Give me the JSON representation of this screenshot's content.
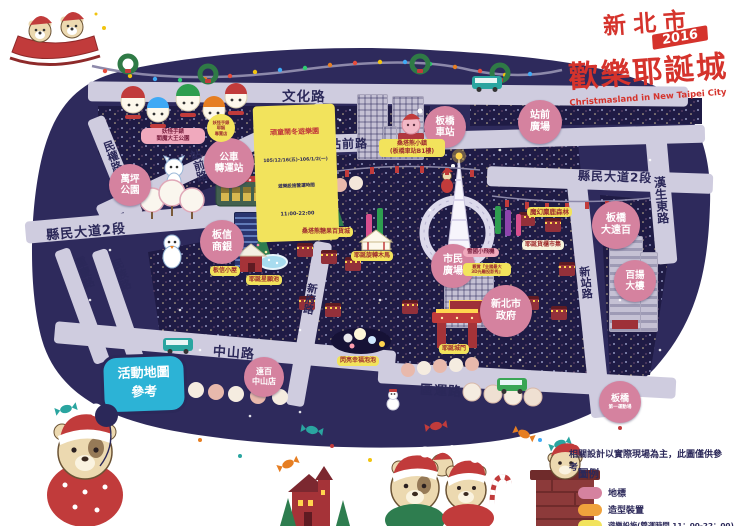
{
  "title": {
    "city": "新北市",
    "main": "歡樂耶誕城",
    "year": "2016",
    "subtitle": "Christmasland in New Taipei City"
  },
  "info_box": {
    "text": "活動地圖\n參考"
  },
  "roads": {
    "wenhua": "文化路",
    "zhanqian": "站前路",
    "xianmin": "縣民大道2段",
    "hansheng": "漢生東路",
    "minquan": "民權路",
    "chongqing": "重慶路",
    "minzu": "民族路",
    "xinfu": "新府路",
    "xinzhan": "新站路",
    "zhongshan": "中山路",
    "quyun": "區運路"
  },
  "landmarks": {
    "banqiao_station": "板橋\n車站",
    "zhanqian_square": "站前\n廣場",
    "bus_terminal": "公車\n轉運站",
    "wanping_park": "萬坪\n公園",
    "banxin_bank": "板信\n商銀",
    "mega_far_eastern": "板橋\n大遠百",
    "baiyang_tower": "百揚\n大樓",
    "civic_square": "市民\n廣場",
    "city_hall": "新北市\n政府",
    "fe_zhongshan": "遠百\n中山店",
    "stadium_line1": "板橋",
    "stadium_line2": "第一運動場"
  },
  "attractions": {
    "playground_title": "頑童鬧冬遊樂園",
    "playground_dates": "105/12/16(五)-106/1/2(一)",
    "playground_line2": "遊樂設施營運時間",
    "playground_hours": "11:00-22:00",
    "santa_bear_town": "桑塔熊小鎮\n(板橋車站B1樓)",
    "yokai_park": "妖怪手錶\n閻魔大王公園",
    "yokai_shop": "妖怪手錶\n耶誕\n專賣店",
    "magic_deer_forest": "魔幻麋鹿森林",
    "container_market": "耶誕貨櫃市集",
    "candy_department": "桑塔熊糖果百貨城",
    "carousel": "耶誕旋轉木馬",
    "banxin_house": "板信小屋",
    "wish_pool": "耶誕星願池",
    "bubble": "閃亮幸福泡泡",
    "gate": "耶誕城門",
    "snow_plane": "雪國小飛機",
    "light_show_note": "觀賞『全國最大\n3D光雕投影秀』"
  },
  "notes": {
    "disclaimer": "相關設計以實際現場為主，此圖僅供參考。"
  },
  "legend": {
    "title": "圖例",
    "items": [
      {
        "label": "地標",
        "color": "#d5829f"
      },
      {
        "label": "造型裝置",
        "color": "#f0a23c"
      },
      {
        "label": "遊樂設施(營運時間 11：00-22：00)",
        "color": "#f2e35c"
      }
    ]
  },
  "colors": {
    "map_bg": "#2e2a5c",
    "city_block": "#1f1b45",
    "road": "#cfccdf",
    "landmark_pink": "#d5829f",
    "title_red": "#d5332c",
    "info_cyan": "#2cb3d6",
    "navy": "#2b2859"
  }
}
